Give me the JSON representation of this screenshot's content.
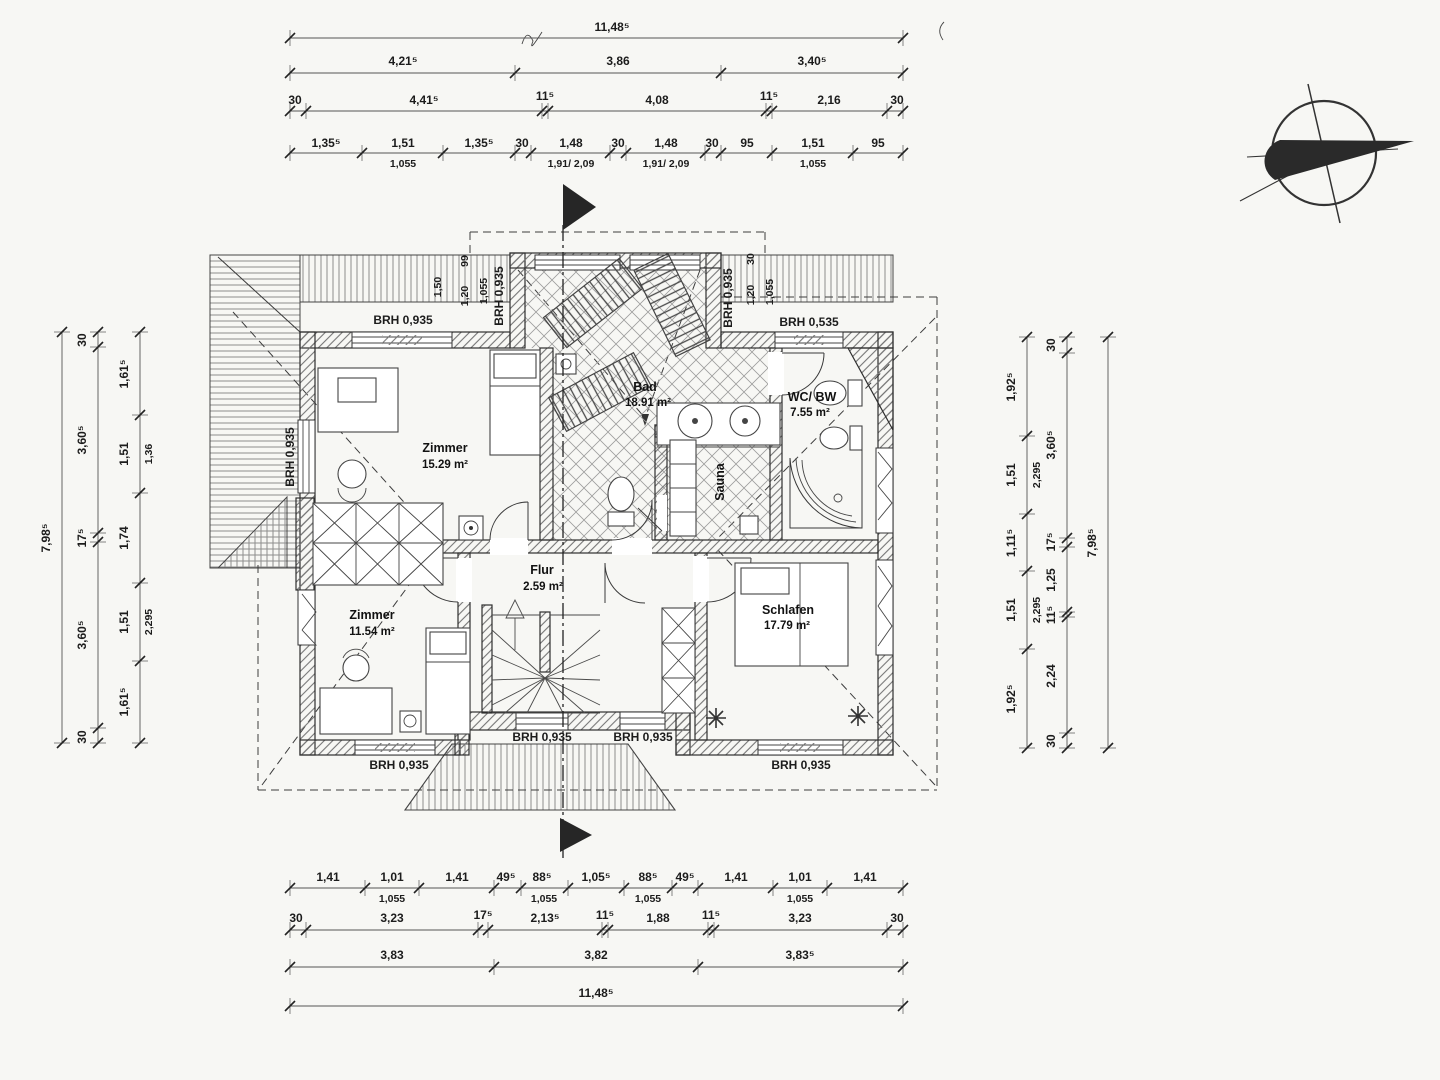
{
  "icons": {
    "north_arrow": "north-arrow-compass",
    "section_marker": "section-cut-flag"
  },
  "rooms": {
    "zimmer_nw": {
      "name": "Zimmer",
      "area": "15.29 m²"
    },
    "zimmer_sw": {
      "name": "Zimmer",
      "area": "11.54 m²"
    },
    "flur": {
      "name": "Flur",
      "area": "2.59 m²"
    },
    "bad": {
      "name": "Bad",
      "area": "18.91 m²"
    },
    "wc_bw": {
      "name": "WC/ BW",
      "area": "7.55 m²"
    },
    "sauna": {
      "name": "Sauna"
    },
    "schlafen": {
      "name": "Schlafen",
      "area": "17.79 m²"
    }
  },
  "sills": {
    "standard": "BRH 0,935",
    "low": "BRH 0,535"
  },
  "small": {
    "d150": "1,50",
    "d99": "99",
    "d120": "1,20",
    "d1055": "1,055",
    "d30": "30"
  },
  "top": {
    "total": "11,48⁵",
    "row2": [
      "4,21⁵",
      "3,86",
      "3,40⁵"
    ],
    "row3": [
      "30",
      "4,41⁵",
      "11⁵",
      "4,08",
      "11⁵",
      "2,16",
      "30"
    ],
    "row4": [
      "1,35⁵",
      "1,51",
      "1,35⁵",
      "30",
      "1,48",
      "30",
      "1,48",
      "30",
      "95",
      "1,51",
      "95"
    ],
    "row4_sub": [
      "1,055",
      "1,91/ 2,09",
      "1,91/ 2,09",
      "1,055"
    ]
  },
  "bottom": {
    "row1": [
      "1,41",
      "1,01",
      "1,41",
      "49⁵",
      "88⁵",
      "1,05⁵",
      "88⁵",
      "49⁵",
      "1,41",
      "1,01",
      "1,41"
    ],
    "row1_sub": [
      "1,055",
      "1,055",
      "1,055",
      "1,055"
    ],
    "row2": [
      "30",
      "3,23",
      "17⁵",
      "2,13⁵",
      "11⁵",
      "1,88",
      "11⁵",
      "3,23",
      "30"
    ],
    "row3": [
      "3,83",
      "3,82",
      "3,83⁵"
    ],
    "total": "11,48⁵"
  },
  "left": {
    "total": "7,98⁵",
    "outer": [
      "30",
      "3,60⁵",
      "17⁵",
      "3,60⁵",
      "30"
    ],
    "inner": [
      "1,61⁵",
      "1,51",
      "1,74",
      "1,51",
      "1,61⁵"
    ],
    "inner_sub": [
      "1,36",
      "2,295"
    ]
  },
  "right": {
    "total": "7,98⁵",
    "outer": [
      "30",
      "3,60⁵",
      "17⁵",
      "1,25",
      "11⁵",
      "2,24",
      "30"
    ],
    "inner": [
      "1,92⁵",
      "1,51",
      "1,11⁵",
      "1,51",
      "1,92⁵"
    ],
    "inner_sub": [
      "2,295",
      "2,295"
    ]
  }
}
